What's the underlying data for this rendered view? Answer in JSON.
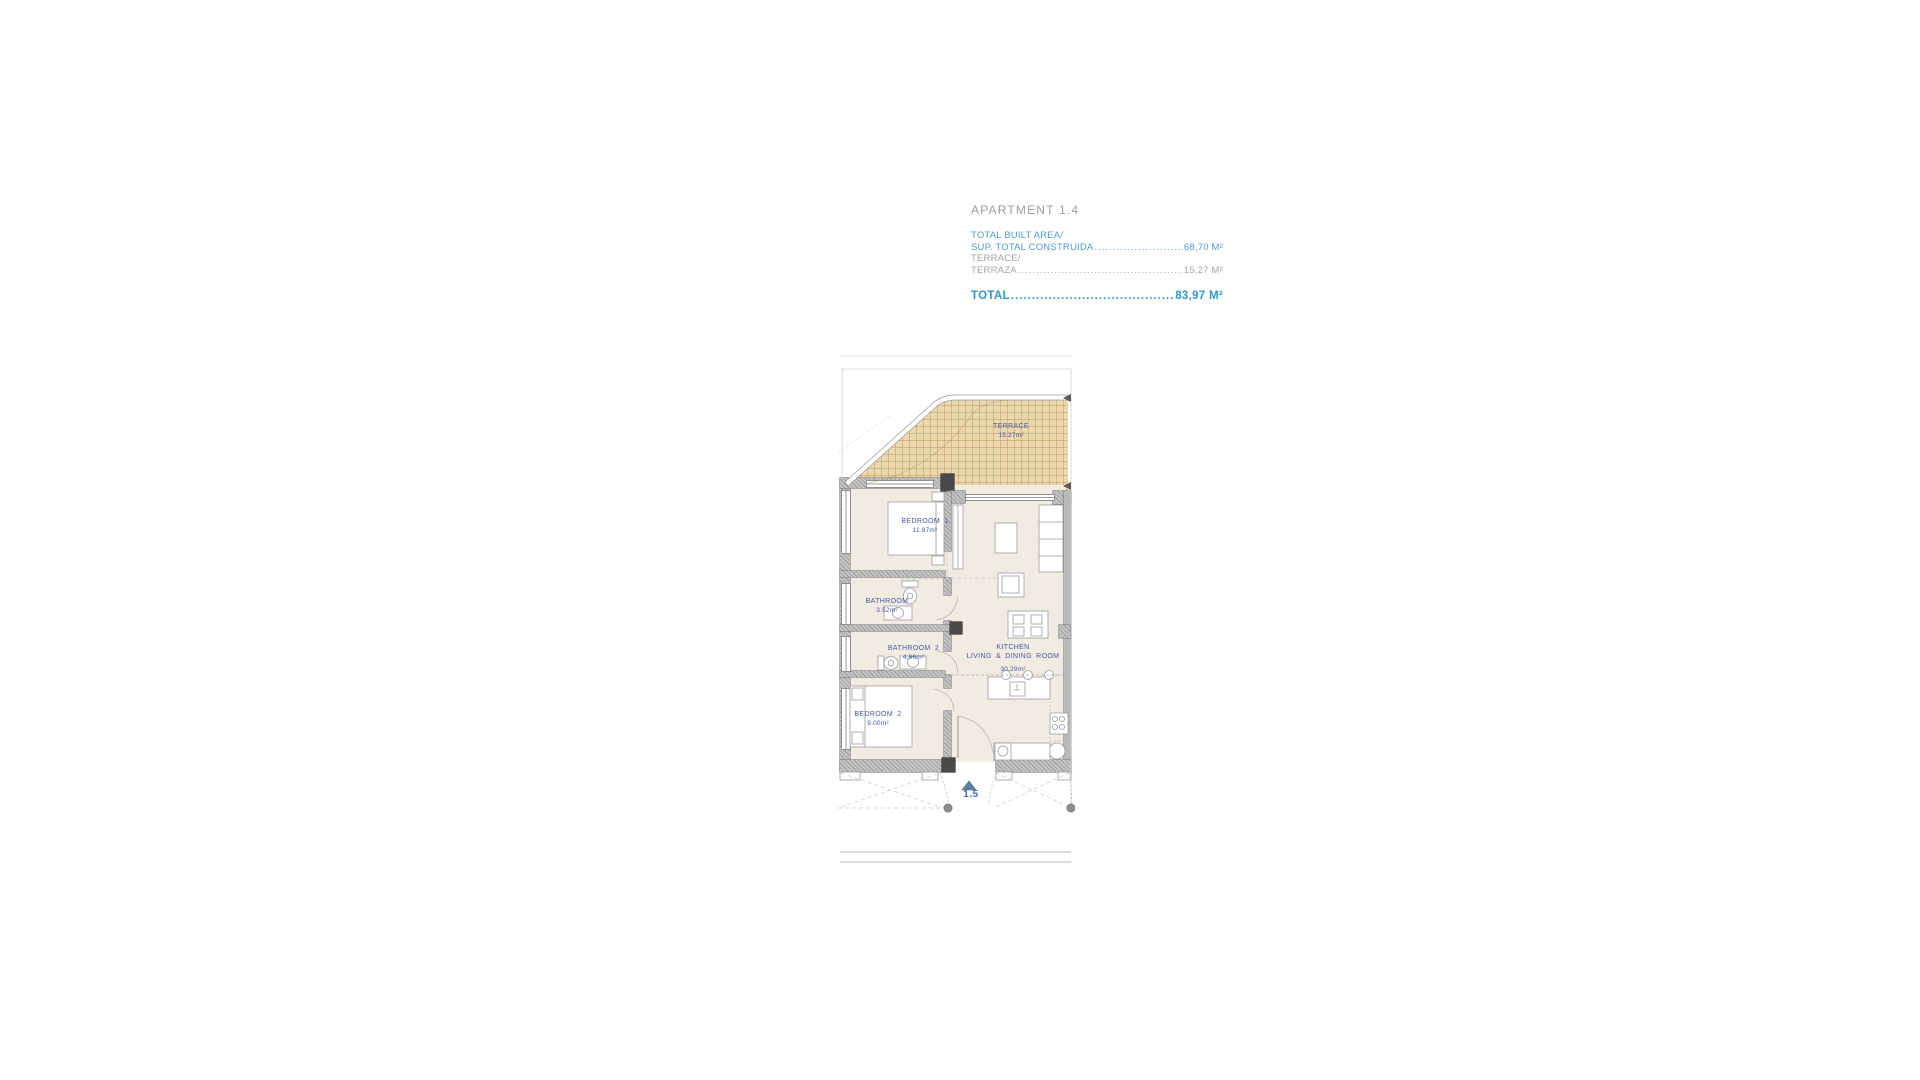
{
  "header": {
    "title": "APARTMENT 1.4",
    "built_area_label": "TOTAL BUILT AREA/",
    "built_area_label2": "SUP. TOTAL CONSTRUIDA",
    "built_area_dots": "......................................................................",
    "built_area_value": "68,70 M²",
    "terrace_label": "TERRACE/",
    "terrace_label2": "TERRAZA",
    "terrace_dots": "..........................................................................................",
    "terrace_value": "15,27 M²",
    "total_label": "TOTAL ",
    "total_dots": "..........................................................................................",
    "total_value": "83,97 M²"
  },
  "plan": {
    "rooms": {
      "terrace": {
        "name": "TERRACE",
        "area": "15.27m²"
      },
      "bedroom1": {
        "name": "BEDROOM 1",
        "area": "11.87m²"
      },
      "bathroom1": {
        "name": "BATHROOM",
        "area": "3.52m²"
      },
      "bathroom2": {
        "name": "BATHROOM 2",
        "area": "4.66m²"
      },
      "bedroom2": {
        "name": "BEDROOM 2",
        "area": "9.00m²"
      },
      "kitchen": {
        "line1": "KITCHEN",
        "line2": "LIVING & DINING ROOM",
        "area": "30.29m²"
      }
    },
    "marker": {
      "label": "1.5"
    }
  },
  "colors": {
    "header_blue": "#4f9bd2",
    "total_blue": "#2e96d2",
    "text_gray": "#a5a5a5",
    "title_gray": "#9d9d9d",
    "room_label_blue": "#4756a6",
    "marker_blue": "#3a6cc0",
    "terrace_fill": "#ebd8af",
    "floor_fill": "#f1ece1",
    "wall_gray": "#c5c5c5"
  }
}
